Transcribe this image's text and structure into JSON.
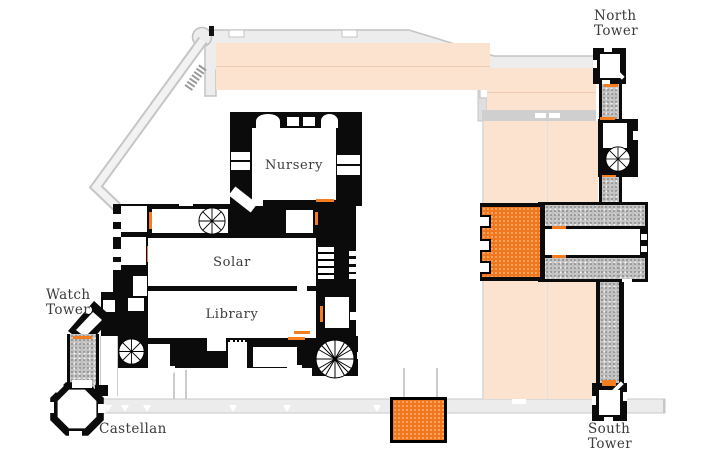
{
  "plan": {
    "labels": {
      "north_tower_line1": "North",
      "north_tower_line2": "Tower",
      "watch_tower_line1": "Watch",
      "watch_tower_line2": "Tower",
      "castellan": "Castellan",
      "south_tower_line1": "South",
      "south_tower_line2": "Tower"
    },
    "rooms": {
      "nursery": "Nursery",
      "solar": "Solar",
      "library": "Library"
    },
    "colors": {
      "structure_black": "#0b0b0b",
      "highlight_orange": "#f0771f",
      "door_orange": "#f57c1f",
      "roof_peach": "#fce3d0",
      "wall_light_gray": "#ededed",
      "corridor_gray": "#c2c2c2",
      "label_text": "#3a3a3a"
    }
  }
}
